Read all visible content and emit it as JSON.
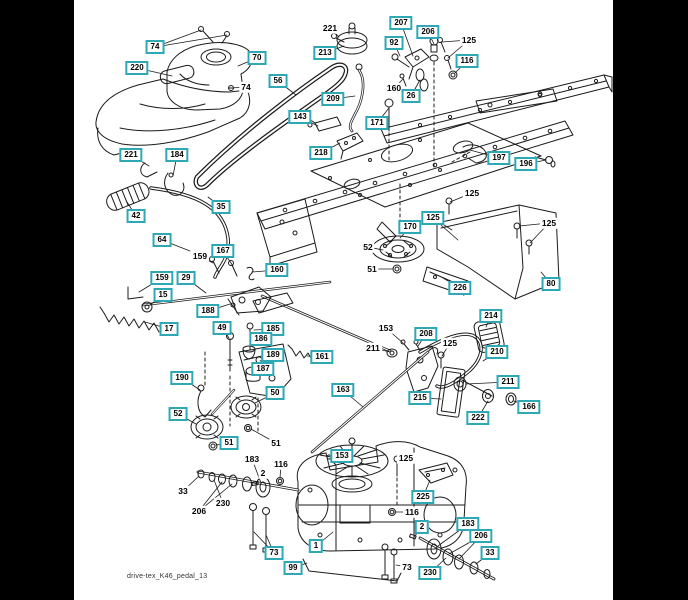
{
  "window": {
    "background_color": "#000000",
    "canvas_color": "#ffffff"
  },
  "diagram": {
    "footer_text": "drive-tex_K46_pedal_13",
    "callout_style": {
      "box_border_color": "#2fa8b5",
      "text_color": "#000000",
      "box_background": "#ffffff"
    },
    "callouts": [
      {
        "label": "74",
        "x": 155,
        "y": 47,
        "boxed": true,
        "targets": [
          [
            201,
            30
          ],
          [
            227,
            35
          ]
        ]
      },
      {
        "label": "220",
        "x": 137,
        "y": 68,
        "boxed": true,
        "targets": [
          [
            172,
            76
          ]
        ]
      },
      {
        "label": "70",
        "x": 257,
        "y": 58,
        "boxed": true,
        "targets": [
          [
            238,
            66
          ]
        ]
      },
      {
        "label": "74",
        "x": 246,
        "y": 87,
        "boxed": false,
        "targets": [
          [
            231,
            88
          ]
        ]
      },
      {
        "label": "56",
        "x": 278,
        "y": 81,
        "boxed": true,
        "targets": [
          [
            296,
            95
          ]
        ]
      },
      {
        "label": "143",
        "x": 300,
        "y": 117,
        "boxed": true,
        "targets": [
          [
            318,
            126
          ]
        ]
      },
      {
        "label": "221",
        "x": 330,
        "y": 28,
        "boxed": false,
        "targets": [
          [
            339,
            37
          ]
        ]
      },
      {
        "label": "213",
        "x": 325,
        "y": 53,
        "boxed": true,
        "targets": [
          [
            344,
            46
          ]
        ]
      },
      {
        "label": "207",
        "x": 401,
        "y": 23,
        "boxed": true,
        "targets": [
          [
            413,
            56
          ]
        ]
      },
      {
        "label": "206",
        "x": 428,
        "y": 32,
        "boxed": true,
        "targets": [
          [
            434,
            44
          ]
        ]
      },
      {
        "label": "92",
        "x": 394,
        "y": 43,
        "boxed": true,
        "targets": [
          [
            400,
            56
          ]
        ]
      },
      {
        "label": "125",
        "x": 469,
        "y": 40,
        "boxed": false,
        "targets": [
          [
            442,
            42
          ],
          [
            448,
            58
          ]
        ]
      },
      {
        "label": "116",
        "x": 467,
        "y": 61,
        "boxed": true,
        "targets": [
          [
            455,
            73
          ]
        ]
      },
      {
        "label": "160",
        "x": 394,
        "y": 88,
        "boxed": false,
        "targets": [
          [
            403,
            79
          ]
        ]
      },
      {
        "label": "26",
        "x": 411,
        "y": 96,
        "boxed": true,
        "targets": [
          [
            420,
            80
          ]
        ]
      },
      {
        "label": "209",
        "x": 333,
        "y": 99,
        "boxed": true,
        "targets": [
          [
            355,
            96
          ]
        ]
      },
      {
        "label": "171",
        "x": 377,
        "y": 123,
        "boxed": true,
        "targets": [
          [
            389,
            108
          ]
        ]
      },
      {
        "label": "218",
        "x": 321,
        "y": 153,
        "boxed": true,
        "targets": [
          [
            340,
            143
          ]
        ]
      },
      {
        "label": "197",
        "x": 499,
        "y": 158,
        "boxed": true,
        "targets": [
          [
            470,
            150
          ]
        ]
      },
      {
        "label": "196",
        "x": 526,
        "y": 164,
        "boxed": true,
        "targets": [
          [
            546,
            160
          ]
        ]
      },
      {
        "label": "221",
        "x": 131,
        "y": 155,
        "boxed": true,
        "targets": [
          [
            149,
            166
          ]
        ]
      },
      {
        "label": "184",
        "x": 177,
        "y": 155,
        "boxed": true,
        "targets": [
          [
            173,
            176
          ]
        ]
      },
      {
        "label": "42",
        "x": 136,
        "y": 216,
        "boxed": true,
        "targets": [
          [
            127,
            202
          ]
        ]
      },
      {
        "label": "35",
        "x": 221,
        "y": 207,
        "boxed": true,
        "targets": [
          [
            208,
            197
          ]
        ]
      },
      {
        "label": "64",
        "x": 162,
        "y": 240,
        "boxed": true,
        "targets": [
          [
            190,
            251
          ]
        ]
      },
      {
        "label": "159",
        "x": 200,
        "y": 256,
        "boxed": false,
        "targets": [
          [
            213,
            263
          ]
        ]
      },
      {
        "label": "167",
        "x": 223,
        "y": 251,
        "boxed": true,
        "targets": [
          [
            233,
            266
          ]
        ]
      },
      {
        "label": "160",
        "x": 277,
        "y": 270,
        "boxed": true,
        "targets": [
          [
            252,
            272
          ]
        ]
      },
      {
        "label": "159",
        "x": 162,
        "y": 278,
        "boxed": true,
        "targets": [
          [
            139,
            292
          ]
        ]
      },
      {
        "label": "29",
        "x": 186,
        "y": 278,
        "boxed": true,
        "targets": [
          [
            206,
            293
          ]
        ]
      },
      {
        "label": "15",
        "x": 163,
        "y": 295,
        "boxed": true,
        "targets": [
          [
            150,
            305
          ]
        ]
      },
      {
        "label": "17",
        "x": 169,
        "y": 329,
        "boxed": true,
        "targets": [
          [
            145,
            322
          ]
        ]
      },
      {
        "label": "188",
        "x": 208,
        "y": 311,
        "boxed": true,
        "targets": [
          [
            230,
            304
          ]
        ]
      },
      {
        "label": "49",
        "x": 222,
        "y": 328,
        "boxed": true,
        "targets": [
          [
            229,
            338
          ]
        ]
      },
      {
        "label": "185",
        "x": 273,
        "y": 329,
        "boxed": true,
        "targets": [
          [
            254,
            330
          ]
        ]
      },
      {
        "label": "186",
        "x": 261,
        "y": 339,
        "boxed": true,
        "targets": [
          [
            252,
            346
          ]
        ]
      },
      {
        "label": "189",
        "x": 273,
        "y": 355,
        "boxed": true,
        "targets": [
          [
            260,
            361
          ]
        ]
      },
      {
        "label": "187",
        "x": 263,
        "y": 369,
        "boxed": true,
        "targets": [
          [
            254,
            372
          ]
        ]
      },
      {
        "label": "190",
        "x": 182,
        "y": 378,
        "boxed": true,
        "targets": [
          [
            200,
            390
          ]
        ]
      },
      {
        "label": "161",
        "x": 322,
        "y": 357,
        "boxed": true,
        "targets": [
          [
            307,
            356
          ]
        ]
      },
      {
        "label": "170",
        "x": 410,
        "y": 227,
        "boxed": true,
        "targets": [
          [
            400,
            238
          ]
        ]
      },
      {
        "label": "52",
        "x": 368,
        "y": 247,
        "boxed": false,
        "targets": [
          [
            383,
            250
          ]
        ]
      },
      {
        "label": "51",
        "x": 372,
        "y": 269,
        "boxed": false,
        "targets": [
          [
            393,
            269
          ]
        ]
      },
      {
        "label": "125",
        "x": 472,
        "y": 193,
        "boxed": false,
        "targets": [
          [
            450,
            202
          ]
        ]
      },
      {
        "label": "125",
        "x": 433,
        "y": 218,
        "boxed": true,
        "targets": [
          [
            452,
            230
          ],
          [
            458,
            240
          ]
        ]
      },
      {
        "label": "125",
        "x": 549,
        "y": 223,
        "boxed": false,
        "targets": [
          [
            519,
            226
          ],
          [
            530,
            243
          ]
        ]
      },
      {
        "label": "226",
        "x": 460,
        "y": 288,
        "boxed": true,
        "targets": [
          [
            443,
            278
          ]
        ]
      },
      {
        "label": "80",
        "x": 551,
        "y": 284,
        "boxed": true,
        "targets": [
          [
            541,
            272
          ]
        ]
      },
      {
        "label": "153",
        "x": 386,
        "y": 328,
        "boxed": false,
        "targets": [
          [
            403,
            343
          ]
        ]
      },
      {
        "label": "211",
        "x": 373,
        "y": 348,
        "boxed": false,
        "targets": [
          [
            390,
            352
          ]
        ]
      },
      {
        "label": "208",
        "x": 426,
        "y": 334,
        "boxed": true,
        "targets": [
          [
            418,
            346
          ]
        ]
      },
      {
        "label": "125",
        "x": 450,
        "y": 343,
        "boxed": false,
        "targets": [
          [
            442,
            356
          ]
        ]
      },
      {
        "label": "214",
        "x": 491,
        "y": 316,
        "boxed": true,
        "targets": [
          [
            486,
            327
          ]
        ]
      },
      {
        "label": "210",
        "x": 497,
        "y": 352,
        "boxed": true,
        "targets": [
          [
            483,
            361
          ]
        ]
      },
      {
        "label": "211",
        "x": 508,
        "y": 382,
        "boxed": true,
        "targets": [
          [
            466,
            384
          ]
        ]
      },
      {
        "label": "215",
        "x": 420,
        "y": 398,
        "boxed": true,
        "targets": [
          [
            441,
            399
          ]
        ]
      },
      {
        "label": "222",
        "x": 478,
        "y": 418,
        "boxed": true,
        "targets": [
          [
            488,
            401
          ]
        ]
      },
      {
        "label": "166",
        "x": 529,
        "y": 407,
        "boxed": true,
        "targets": [
          [
            514,
            401
          ]
        ]
      },
      {
        "label": "163",
        "x": 343,
        "y": 390,
        "boxed": true,
        "targets": [
          [
            363,
            407
          ]
        ]
      },
      {
        "label": "52",
        "x": 178,
        "y": 414,
        "boxed": true,
        "targets": [
          [
            196,
            424
          ]
        ]
      },
      {
        "label": "50",
        "x": 275,
        "y": 393,
        "boxed": true,
        "targets": [
          [
            255,
            403
          ]
        ]
      },
      {
        "label": "51",
        "x": 229,
        "y": 443,
        "boxed": true,
        "targets": [
          [
            216,
            445
          ]
        ]
      },
      {
        "label": "51",
        "x": 276,
        "y": 443,
        "boxed": false,
        "targets": [
          [
            251,
            429
          ]
        ]
      },
      {
        "label": "33",
        "x": 183,
        "y": 491,
        "boxed": false,
        "targets": [
          [
            199,
            476
          ]
        ]
      },
      {
        "label": "230",
        "x": 223,
        "y": 503,
        "boxed": false,
        "targets": [
          [
            214,
            480
          ]
        ]
      },
      {
        "label": "206",
        "x": 199,
        "y": 511,
        "boxed": false,
        "targets": [
          [
            222,
            482
          ],
          [
            232,
            484
          ]
        ]
      },
      {
        "label": "183",
        "x": 252,
        "y": 459,
        "boxed": false,
        "targets": [
          [
            261,
            483
          ]
        ]
      },
      {
        "label": "116",
        "x": 281,
        "y": 464,
        "boxed": false,
        "targets": [
          [
            280,
            478
          ]
        ]
      },
      {
        "label": "2",
        "x": 263,
        "y": 473,
        "boxed": false,
        "targets": [
          [
            256,
            483
          ]
        ]
      },
      {
        "label": "153",
        "x": 342,
        "y": 456,
        "boxed": true,
        "targets": [
          [
            331,
            459
          ]
        ]
      },
      {
        "label": "125",
        "x": 406,
        "y": 458,
        "boxed": false,
        "targets": [
          [
            398,
            461
          ]
        ]
      },
      {
        "label": "225",
        "x": 423,
        "y": 497,
        "boxed": true,
        "targets": [
          [
            430,
            480
          ]
        ]
      },
      {
        "label": "116",
        "x": 412,
        "y": 512,
        "boxed": false,
        "targets": [
          [
            395,
            512
          ]
        ]
      },
      {
        "label": "1",
        "x": 316,
        "y": 546,
        "boxed": true,
        "targets": [
          [
            333,
            532
          ]
        ]
      },
      {
        "label": "73",
        "x": 274,
        "y": 553,
        "boxed": true,
        "targets": [
          [
            254,
            532
          ],
          [
            266,
            535
          ]
        ]
      },
      {
        "label": "99",
        "x": 293,
        "y": 568,
        "boxed": true,
        "targets": [
          [
            307,
            563
          ]
        ]
      },
      {
        "label": "73",
        "x": 407,
        "y": 567,
        "boxed": false,
        "targets": [
          [
            396,
            565
          ]
        ]
      },
      {
        "label": "2",
        "x": 422,
        "y": 527,
        "boxed": true,
        "targets": [
          [
            414,
            537
          ]
        ]
      },
      {
        "label": "183",
        "x": 468,
        "y": 524,
        "boxed": true,
        "targets": [
          [
            438,
            546
          ]
        ]
      },
      {
        "label": "206",
        "x": 481,
        "y": 536,
        "boxed": true,
        "targets": [
          [
            449,
            554
          ],
          [
            459,
            559
          ]
        ]
      },
      {
        "label": "33",
        "x": 490,
        "y": 553,
        "boxed": true,
        "targets": [
          [
            476,
            564
          ]
        ]
      },
      {
        "label": "230",
        "x": 430,
        "y": 573,
        "boxed": true,
        "targets": [
          [
            446,
            558
          ]
        ]
      }
    ]
  }
}
